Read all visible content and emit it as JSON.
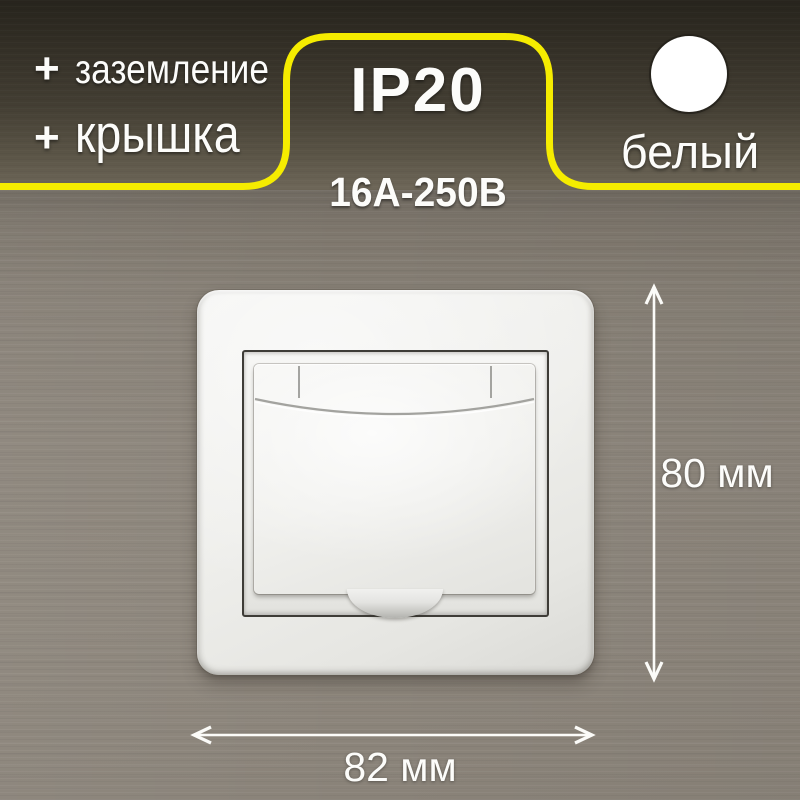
{
  "header": {
    "features": [
      {
        "prefix": "+",
        "label": "заземление"
      },
      {
        "prefix": "+",
        "label": "крышка"
      }
    ],
    "spec_box": {
      "protection_class": "IP20",
      "rating": "16А-250В"
    },
    "swatch": {
      "label": "белый"
    }
  },
  "dimensions": {
    "height_label": "80 мм",
    "width_label": "82 мм"
  },
  "colors": {
    "accent": "#f5ec00",
    "swatch": "#ffffff",
    "text": "#fcfcfa"
  }
}
